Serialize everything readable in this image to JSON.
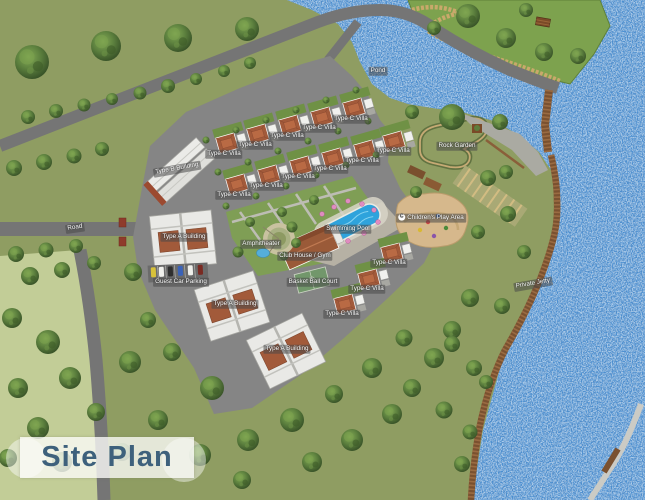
{
  "title": "Site Plan",
  "labels": {
    "pond": "Pond",
    "road": "Road",
    "rock_garden": "Rock Garden",
    "children_play_area": "Children's Play Area",
    "swimming_pool": "Swimming Pool",
    "club_house": "Club House / Gym",
    "amphitheater": "Amphitheater",
    "basket_ball_court": "Basket Ball Court",
    "type_c_villa": "Type C Villa",
    "type_a_building": "Type A Building",
    "type_b_building": "Type B Building",
    "guest_car_parking": "Guest Car Parking",
    "private_jetty": "Private Jetty"
  },
  "counts": {
    "type_c_villa_labels": 14,
    "type_a_building_labels": 3
  },
  "colors": {
    "water": "#4a8fd2",
    "grass": "#8f9d62",
    "grass_light": "#c2cd97",
    "peninsula_green": "#7da24e",
    "road": "#757575",
    "development_paving": "#858585",
    "villa_roof": "#a25a3a",
    "pool": "#2ea3dc",
    "jetty_wood": "#7a5130",
    "sand_play_area": "#d6b88c",
    "title_text": "#3e617c",
    "label_background": "rgba(72,72,72,0.55)"
  }
}
